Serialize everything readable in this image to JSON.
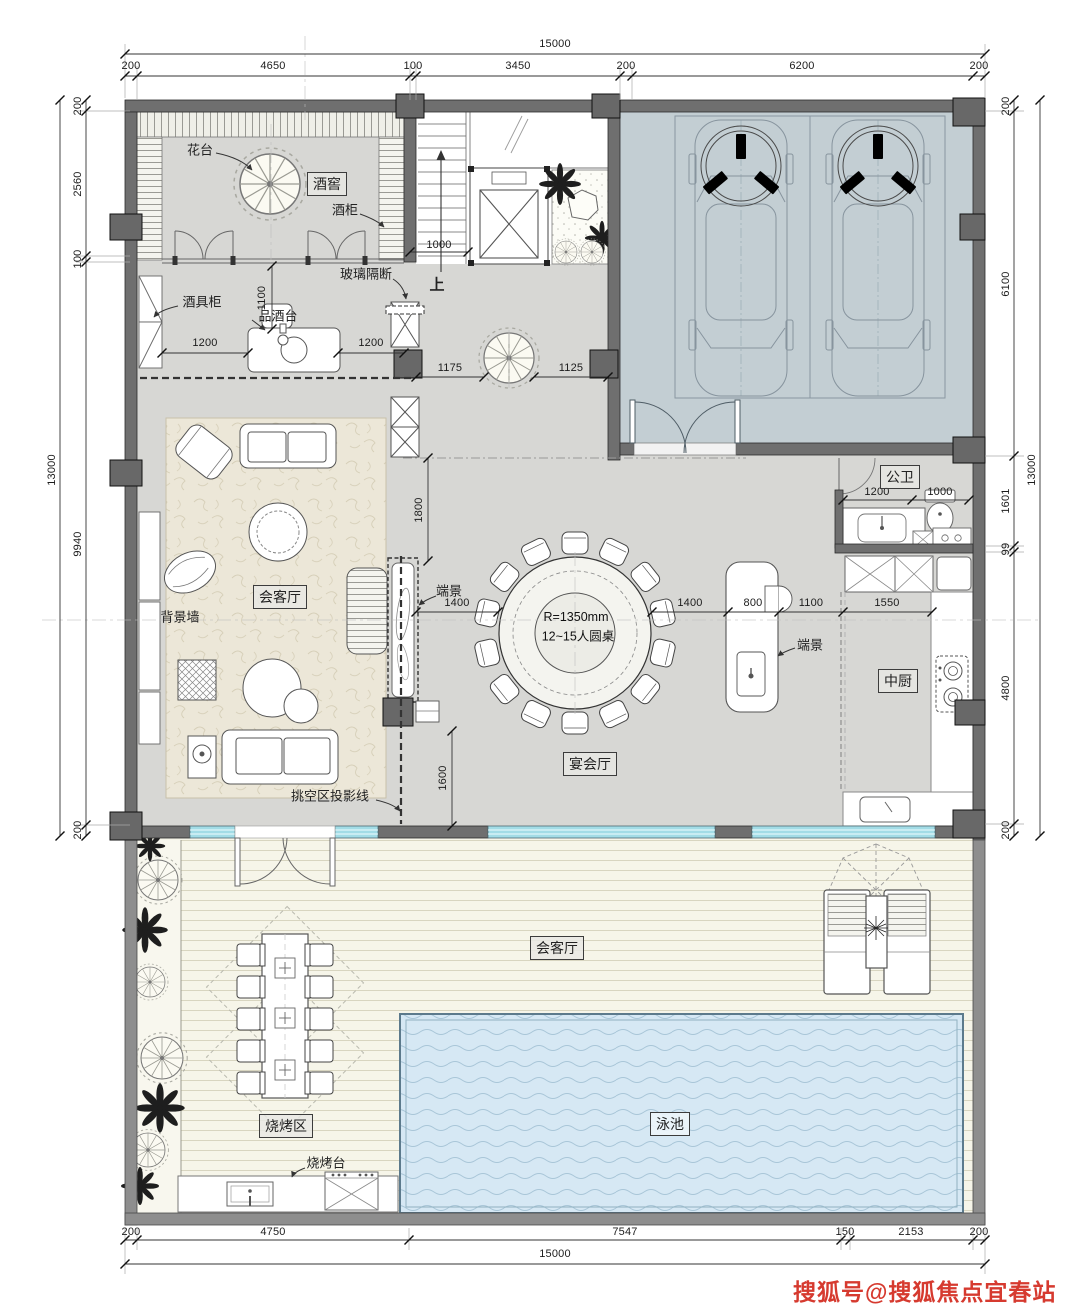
{
  "watermark": {
    "text": "搜狐号@搜狐焦点宜春站"
  },
  "rooms": {
    "wine_cellar": "酒窖",
    "bathroom": "公卫",
    "kitchen": "中厨",
    "living": "会客厅",
    "banquet": "宴会厅",
    "bbq": "烧烤区",
    "pool": "泳池",
    "terrace_lounge": "会客厅"
  },
  "annotations": {
    "flower_stand": "花台",
    "wine_cabinet": "酒柜",
    "barware_cabinet": "酒具柜",
    "tasting_table": "品酒台",
    "glass_partition": "玻璃隔断",
    "stairs_up": "上",
    "feature_wall": "背景墙",
    "end_scene_living": "端景",
    "end_scene_island": "端景",
    "void_projection": "挑空区投影线",
    "bbq_counter": "烧烤台",
    "table_radius": "R=1350mm",
    "table_capacity": "12~15人圆桌"
  },
  "dimensions": {
    "top_total": "15000",
    "top": [
      "200",
      "4650",
      "100",
      "3450",
      "200",
      "6200",
      "200"
    ],
    "left_total": "13000",
    "left": [
      "200",
      "2560",
      "100",
      "9940",
      "200"
    ],
    "right_total": "13000",
    "right": [
      "200",
      "6100",
      "1601",
      "99",
      "4800",
      "200"
    ],
    "bottom_total": "15000",
    "bottom": [
      "200",
      "4750",
      "7547",
      "150",
      "2153",
      "200"
    ],
    "interior": {
      "wine_height": "1100",
      "tasting_left": "1200",
      "tasting_right": "1200",
      "stair_width": "1000",
      "column_left": "1175",
      "column_right": "1125",
      "gallery": "1800",
      "table_left": "1400",
      "table_right": "1400",
      "island": "800",
      "island_gap": "1100",
      "kitchen_width": "1550",
      "bath_vanity": "1200",
      "bath_wc": "1000",
      "void_depth": "1600"
    }
  },
  "colors": {
    "wall": "#6f6f6f",
    "terrace_wall": "#8e8e8e",
    "floor": "#d7d7d4",
    "garage_floor": "#c3ced3",
    "carpet": "#ece7d8",
    "deck": "#f6f5e9",
    "pool_water": "#d6e8f4",
    "window_glass": "#a2dce6",
    "watermark": "#d63a2f"
  }
}
